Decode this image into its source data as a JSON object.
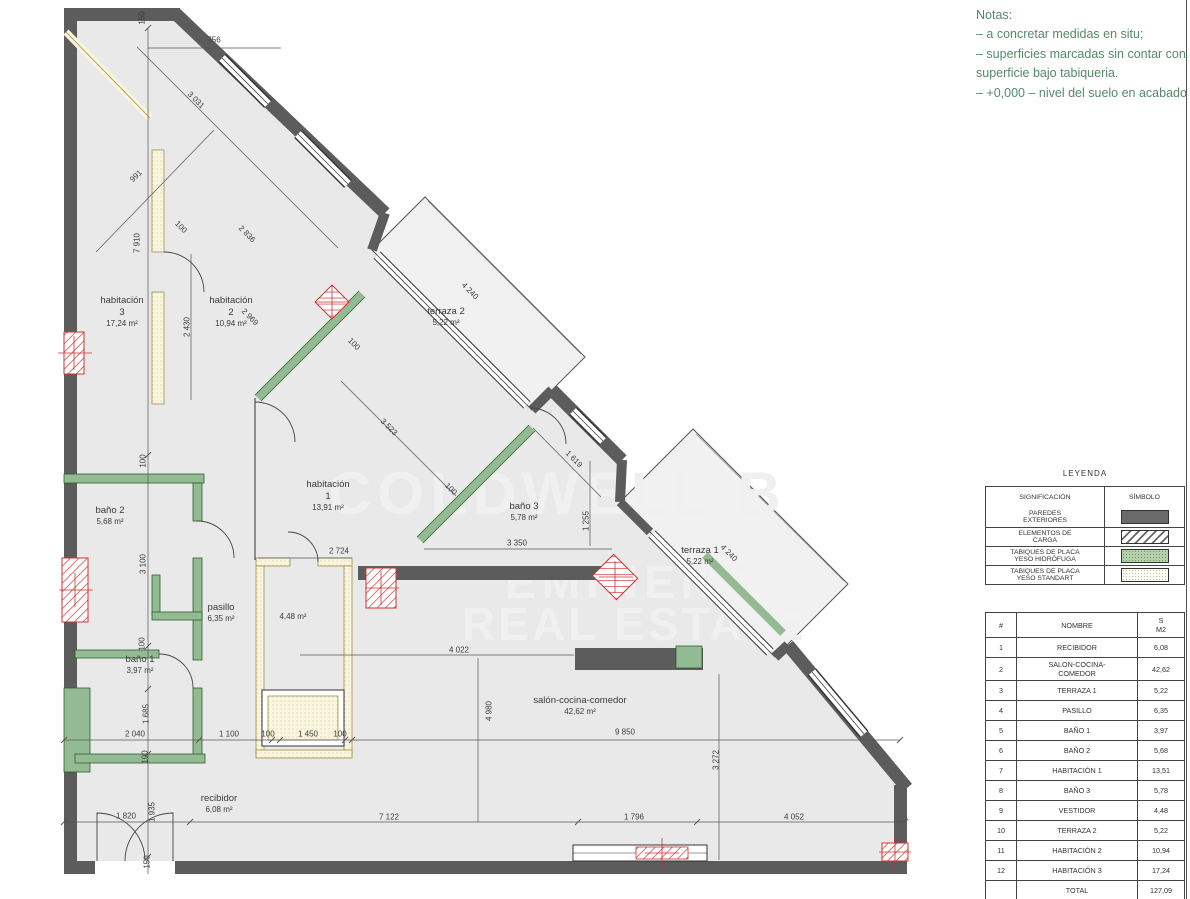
{
  "colors": {
    "wall": "#5c5c5c",
    "partition_green": "#93bb93",
    "partition_cream": "#faf5e0",
    "load_red": "#cc3333",
    "notes_green": "#55896a",
    "floor": "#e9e9e9"
  },
  "notes": {
    "title": "Notas:",
    "lines": [
      "– a concretar medidas en situ;",
      "– superficies marcadas sin contar con",
      "superficie bajo tabiqueria.",
      "– +0,000 – nivel del suelo en acabado"
    ]
  },
  "watermark": {
    "line1": "COLDWELL B",
    "line2": "EMINENT",
    "line3": "REAL ESTATE"
  },
  "legend": {
    "title": "LEYENDA",
    "headers": [
      "SIGNIFICACIÓN",
      "SÍMBOLO"
    ],
    "rows": [
      {
        "label": "PAREDES\nEXTERIORES",
        "symbol": "solid-dark"
      },
      {
        "label": "ELEMENTOS DE\nCARGA",
        "symbol": "diagonal-hatch"
      },
      {
        "label": "TABIQUES DE PLACA\nYESO HIDRÓFUGA",
        "symbol": "green-dotted"
      },
      {
        "label": "TABIQUES DE PLACA\nYESO STANDART",
        "symbol": "plain-dotted"
      }
    ]
  },
  "rooms_table": {
    "headers": [
      "#",
      "NOMBRE",
      "S\nM2"
    ],
    "rows": [
      [
        "1",
        "RECIBIDOR",
        "6,08"
      ],
      [
        "2",
        "SALON-COCINA-\nCOMEDOR",
        "42,62"
      ],
      [
        "3",
        "TERRAZA 1",
        "5,22"
      ],
      [
        "4",
        "PASILLO",
        "6,35"
      ],
      [
        "5",
        "BAÑO 1",
        "3,97"
      ],
      [
        "6",
        "BAÑO 2",
        "5,68"
      ],
      [
        "7",
        "HABITACIÓN 1",
        "13,51"
      ],
      [
        "8",
        "BAÑO 3",
        "5,78"
      ],
      [
        "9",
        "VESTIDOR",
        "4,48"
      ],
      [
        "10",
        "TERRAZA 2",
        "5,22"
      ],
      [
        "11",
        "HABITACIÓN 2",
        "10,94"
      ],
      [
        "12",
        "HABITACIÓN 3",
        "17,24"
      ]
    ],
    "total_label": "TOTAL",
    "total_value": "127,09"
  },
  "plan": {
    "room_labels": [
      {
        "lines": [
          "habitación",
          "3",
          "17,24 m²"
        ],
        "x": 122,
        "y": 312
      },
      {
        "lines": [
          "habitación",
          "2",
          "10,94 m²"
        ],
        "x": 231,
        "y": 312
      },
      {
        "lines": [
          "terraza 2",
          "5,22 m²"
        ],
        "x": 446,
        "y": 317
      },
      {
        "lines": [
          "habitación",
          "1",
          "13,91 m²"
        ],
        "x": 328,
        "y": 496
      },
      {
        "lines": [
          "baño 3",
          "5,78 m²"
        ],
        "x": 524,
        "y": 512
      },
      {
        "lines": [
          "baño 2",
          "5,68 m²"
        ],
        "x": 110,
        "y": 516
      },
      {
        "lines": [
          "pasillo",
          "6,35 m²"
        ],
        "x": 221,
        "y": 613
      },
      {
        "lines": [
          "4,48 m²"
        ],
        "x": 293,
        "y": 617
      },
      {
        "lines": [
          "baño 1",
          "3,97 m²"
        ],
        "x": 140,
        "y": 665
      },
      {
        "lines": [
          "terraza 1",
          "5,22 m²"
        ],
        "x": 700,
        "y": 556
      },
      {
        "lines": [
          "salón-cocina-comedor",
          "42,62 m²"
        ],
        "x": 580,
        "y": 706
      },
      {
        "lines": [
          "recibidor",
          "6,08 m²"
        ],
        "x": 219,
        "y": 804
      }
    ],
    "dims": [
      {
        "t": "150",
        "x": 142,
        "y": 18,
        "r": -90
      },
      {
        "t": "756",
        "x": 214,
        "y": 40,
        "r": 0
      },
      {
        "t": "991",
        "x": 136,
        "y": 176,
        "r": -45
      },
      {
        "t": "3 031",
        "x": 196,
        "y": 100,
        "r": 45
      },
      {
        "t": "7 910",
        "x": 137,
        "y": 243,
        "r": -90
      },
      {
        "t": "100",
        "x": 181,
        "y": 227,
        "r": 45
      },
      {
        "t": "2 836",
        "x": 247,
        "y": 234,
        "r": 45
      },
      {
        "t": "2 969",
        "x": 250,
        "y": 317,
        "r": 45
      },
      {
        "t": "2 430",
        "x": 187,
        "y": 327,
        "r": -90
      },
      {
        "t": "4 240",
        "x": 470,
        "y": 291,
        "r": 45
      },
      {
        "t": "100",
        "x": 354,
        "y": 344,
        "r": 45
      },
      {
        "t": "3 523",
        "x": 389,
        "y": 427,
        "r": 45
      },
      {
        "t": "100",
        "x": 451,
        "y": 489,
        "r": 45
      },
      {
        "t": "1 619",
        "x": 574,
        "y": 459,
        "r": 45
      },
      {
        "t": "1 255",
        "x": 586,
        "y": 521,
        "r": -90
      },
      {
        "t": "3 350",
        "x": 517,
        "y": 543,
        "r": 0
      },
      {
        "t": "2 724",
        "x": 339,
        "y": 551,
        "r": 0
      },
      {
        "t": "100",
        "x": 143,
        "y": 461,
        "r": -90
      },
      {
        "t": "3 100",
        "x": 143,
        "y": 564,
        "r": -90
      },
      {
        "t": "100",
        "x": 142,
        "y": 644,
        "r": -90
      },
      {
        "t": "4 240",
        "x": 729,
        "y": 553,
        "r": 45
      },
      {
        "t": "4 022",
        "x": 459,
        "y": 650,
        "r": 0
      },
      {
        "t": "1 685",
        "x": 146,
        "y": 714,
        "r": -90
      },
      {
        "t": "2 040",
        "x": 135,
        "y": 734,
        "r": 0
      },
      {
        "t": "1 100",
        "x": 229,
        "y": 734,
        "r": 0
      },
      {
        "t": "100",
        "x": 268,
        "y": 734,
        "r": 0
      },
      {
        "t": "1 450",
        "x": 308,
        "y": 734,
        "r": 0
      },
      {
        "t": "100",
        "x": 340,
        "y": 734,
        "r": 0
      },
      {
        "t": "100",
        "x": 145,
        "y": 757,
        "r": -90
      },
      {
        "t": "4 980",
        "x": 489,
        "y": 711,
        "r": -90
      },
      {
        "t": "9 850",
        "x": 625,
        "y": 732,
        "r": 0
      },
      {
        "t": "3 272",
        "x": 716,
        "y": 760,
        "r": -90
      },
      {
        "t": "1 820",
        "x": 126,
        "y": 816,
        "r": 0
      },
      {
        "t": "1 935",
        "x": 152,
        "y": 812,
        "r": -90
      },
      {
        "t": "7 122",
        "x": 389,
        "y": 817,
        "r": 0
      },
      {
        "t": "1 796",
        "x": 634,
        "y": 817,
        "r": 0
      },
      {
        "t": "4 052",
        "x": 794,
        "y": 817,
        "r": 0
      },
      {
        "t": "150",
        "x": 147,
        "y": 862,
        "r": -90
      }
    ]
  }
}
